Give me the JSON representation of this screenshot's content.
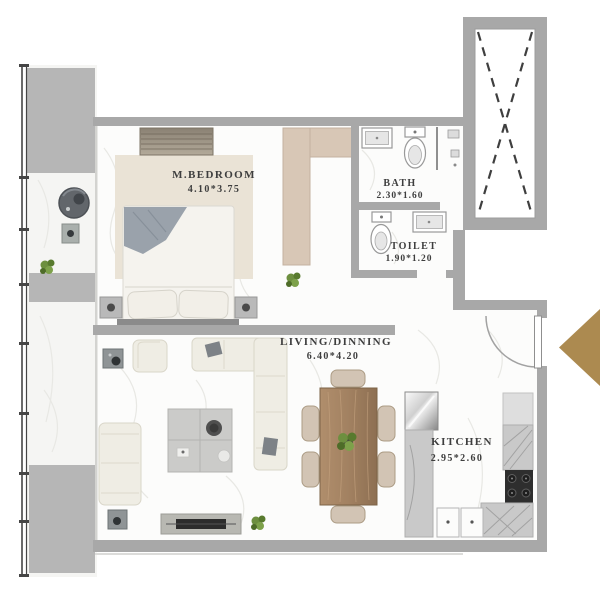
{
  "plan_title": "apartment-floor-plan",
  "rooms": {
    "bedroom": {
      "name": "M.BEDROOM",
      "dims": "4.10*3.75"
    },
    "bath": {
      "name": "BATH",
      "dims": "2.30*1.60"
    },
    "toilet": {
      "name": "TOILET",
      "dims": "1.90*1.20"
    },
    "living": {
      "name": "LIVING/DINNING",
      "dims": "6.40*4.20"
    },
    "kitchen": {
      "name": "KITCHEN",
      "dims": "2.95*2.60"
    }
  },
  "icons": {
    "entrance_arrow": "left-pointing-triangle",
    "shaft_cross": "dashed-x-void",
    "door_swing": "quarter-arc"
  },
  "colors": {
    "wall": "#a8a8a8",
    "block": "#b6b6b6",
    "floor": "#fcfcfb",
    "balcony_floor": "#f5f5f3",
    "vein": "#e8e8e4",
    "label": "#3e3e3e",
    "accent_gold": "#ac8a50",
    "rug": "#eae3d6",
    "closet_tan": "#d8c7b6",
    "wood": "#a5845f",
    "sofa_cream": "#efede4",
    "counter_gray": "#c9c9c9",
    "fixture_line": "#999999",
    "plant_green": "#6d8f3f",
    "railing": "#454545",
    "bed_throw": "#9aa2ab"
  }
}
